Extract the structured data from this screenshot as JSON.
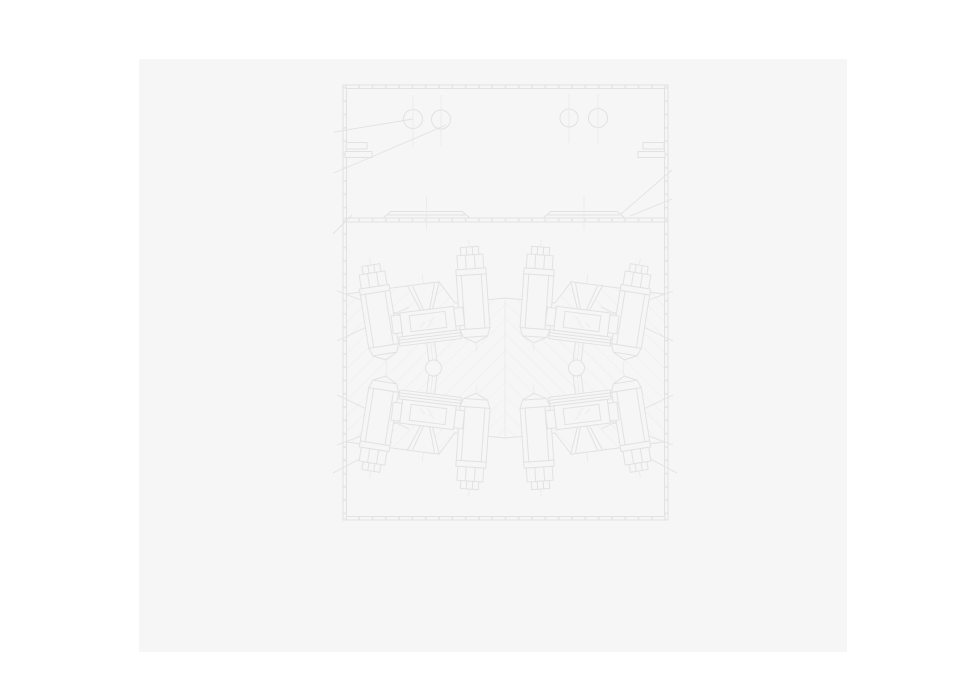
{
  "theme": {
    "page": "#ffffff",
    "panel": "#f6f6f6",
    "line": "#e2e2e4",
    "light": "#eaeaec",
    "hatch": "#ececee",
    "tick": "#e7e7e9"
  },
  "figure": {
    "kind": "technical-cross-section-drawing",
    "upper_chamber_circle_count": 4,
    "fastener_group_count": 4,
    "bolts_per_group": 2,
    "pivot_ball_count": 2,
    "rail_plate_count": 2,
    "hatched_body": true,
    "visible_text": ""
  }
}
